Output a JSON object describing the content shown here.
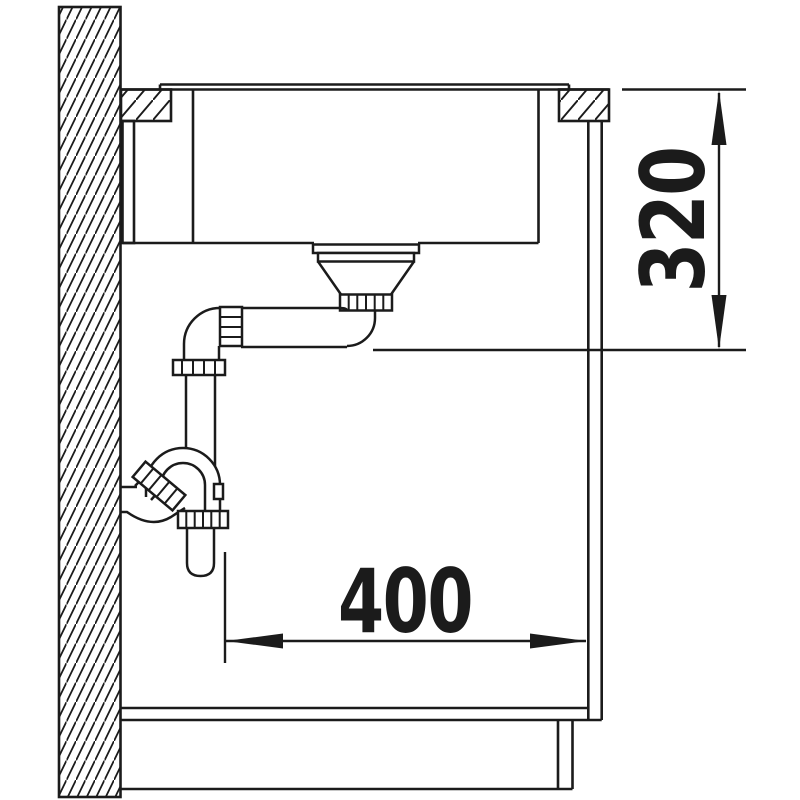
{
  "diagram": {
    "background": "#ffffff",
    "line_color": "#1b1b1b",
    "dimensions": {
      "vertical": {
        "value": "320"
      },
      "horizontal": {
        "value": "400"
      }
    }
  }
}
